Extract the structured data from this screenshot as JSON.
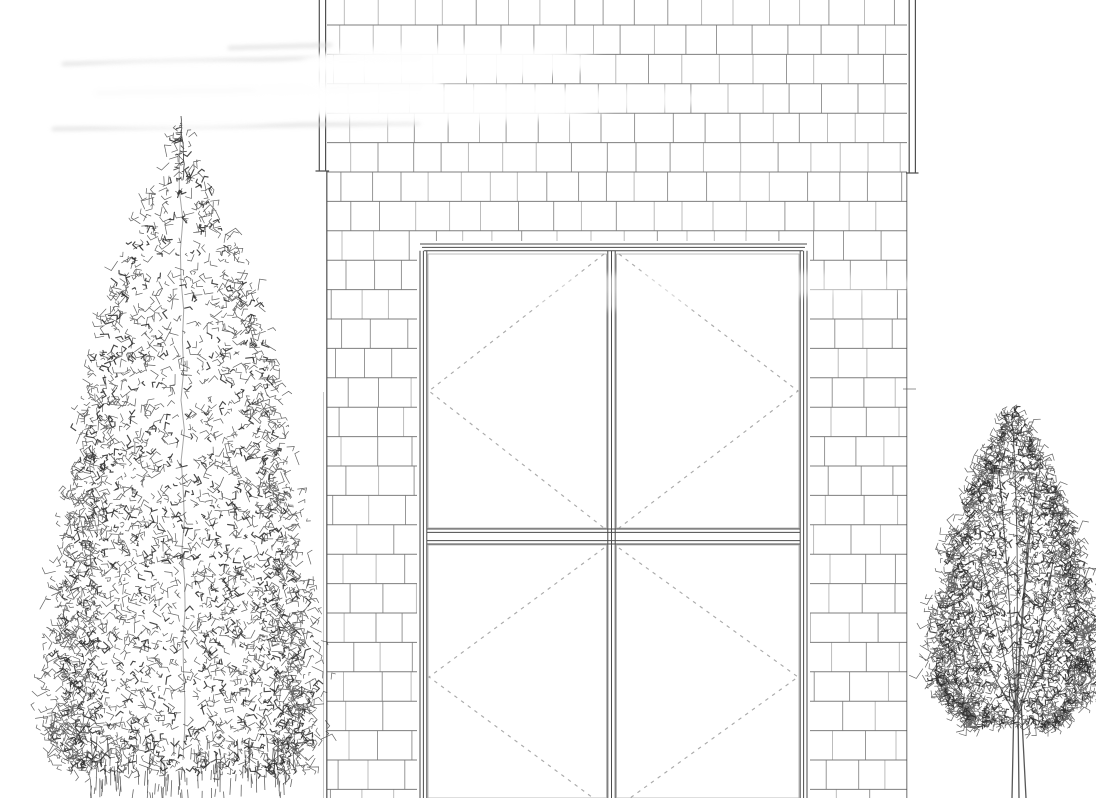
{
  "page": {
    "width": 1096,
    "height": 798,
    "background": "#ffffff",
    "description": "Black-and-white architectural elevation line drawing: cedar-shingle wall with a large four-sash casement window marked by dashed opening indicators, flanked by a hand-sketched conifer on the left and a dense round-crowned tree on the right; faint white scan streaks wash out lines in the upper-left area."
  },
  "colors": {
    "paper": "#ffffff",
    "shingle_joint": "#787878",
    "shingle_course": "#616161",
    "wall_edge": "#4d4d4d",
    "trim": "#3d3d3d",
    "frame": "#3c3c3c",
    "sash": "#6e6e6e",
    "dash": "#9b9b9b",
    "tree": "#272727",
    "tree_branch": "#3a3a3a",
    "ghost": "#d9d9d9"
  },
  "seed": 11,
  "wall": {
    "left": 327,
    "right": 907,
    "top": 0,
    "bottom": 798,
    "trim_left_lines": [
      319.3,
      325.6
    ],
    "trim_right_lines": [
      909.2,
      915.4
    ],
    "trim_left_bottom": 171,
    "trim_right_bottom": 173,
    "right_tick_y": 389
  },
  "shingles": {
    "first_course_line_y": 25,
    "course_height": 29.4,
    "joint_base_spacing": 26,
    "joint_jitter": 13
  },
  "window": {
    "outer_left": 420,
    "outer_top": 244,
    "outer_right": 807,
    "frame_offsets": [
      0,
      3.4,
      6.8
    ],
    "mullion_lines": [
      607.8,
      611.5,
      615.2
    ],
    "rail_lines": [
      529,
      532.4,
      540.6,
      544
    ],
    "rail_x1": 427,
    "rail_x2": 800,
    "sash_rects": [
      [
        428,
        254,
        606.5,
        528
      ],
      [
        616.5,
        254,
        799,
        528
      ],
      [
        428,
        545,
        606.5,
        798
      ],
      [
        616.5,
        545,
        799,
        798
      ]
    ],
    "chevrons": [
      [
        604,
        254,
        429,
        391,
        604,
        528
      ],
      [
        619,
        254,
        798,
        391,
        619,
        528
      ],
      [
        604,
        548,
        429,
        677,
        604,
        806
      ],
      [
        619,
        548,
        798,
        677,
        619,
        806
      ]
    ],
    "dash_pattern": "3.5 4.8"
  },
  "artifacts": {
    "ghost_streaks": [
      [
        62,
        64,
        418,
        56
      ],
      [
        96,
        93,
        420,
        87
      ],
      [
        52,
        129,
        420,
        123
      ],
      [
        228,
        48,
        332,
        45
      ]
    ],
    "white_washes": [
      [
        452,
        62,
        150,
        17,
        0.95
      ],
      [
        446,
        104,
        170,
        19,
        0.93
      ],
      [
        348,
        86,
        95,
        27,
        0.9
      ],
      [
        612,
        99,
        95,
        11,
        0.7
      ],
      [
        730,
        284,
        190,
        13,
        0.5
      ],
      [
        636,
        301,
        120,
        9,
        0.4
      ],
      [
        180,
        95,
        150,
        34,
        0.85
      ]
    ]
  },
  "trees": {
    "left": {
      "cx": 181,
      "tip_y": 118,
      "base_y": 772,
      "stroke_count": 2800,
      "dark_count": 680,
      "bias": 0.5,
      "width_profile": [
        [
          0,
          2.5
        ],
        [
          0.08,
          17
        ],
        [
          0.2,
          55
        ],
        [
          0.35,
          85
        ],
        [
          0.5,
          98
        ],
        [
          0.65,
          110
        ],
        [
          0.8,
          122
        ],
        [
          0.92,
          127
        ],
        [
          1,
          112
        ]
      ],
      "spike": {
        "x": 181,
        "y1": 116,
        "y2": 180,
        "ticks": 16
      },
      "trunk": {
        "x1": 181,
        "y1": 130,
        "x2": 184,
        "y2": 762
      },
      "grass": {
        "x1": 86,
        "x2": 298,
        "y1": 736,
        "y2": 793,
        "count": 140
      }
    },
    "right": {
      "cx": 1014,
      "tip_y": 410,
      "base_y": 728,
      "stroke_count": 2600,
      "dark_count": 520,
      "bias": 0.7,
      "width_profile": [
        [
          0,
          3
        ],
        [
          0.12,
          24
        ],
        [
          0.28,
          46
        ],
        [
          0.45,
          62
        ],
        [
          0.62,
          73
        ],
        [
          0.78,
          79
        ],
        [
          0.9,
          73
        ],
        [
          1,
          40
        ]
      ],
      "trunk_lines": [
        [
          1012,
          798,
          1014,
          700
        ],
        [
          1026,
          798,
          1021,
          700
        ],
        [
          1019,
          798,
          1018,
          706
        ]
      ],
      "branches": [
        [
          1016,
          712,
          981,
          562
        ],
        [
          1016,
          710,
          999,
          470
        ],
        [
          1015,
          708,
          1013,
          430
        ],
        [
          1017,
          710,
          1037,
          472
        ],
        [
          1018,
          712,
          1053,
          562
        ],
        [
          1015,
          714,
          969,
          626
        ],
        [
          1019,
          714,
          1061,
          633
        ],
        [
          1016,
          712,
          1030,
          520
        ]
      ]
    }
  }
}
